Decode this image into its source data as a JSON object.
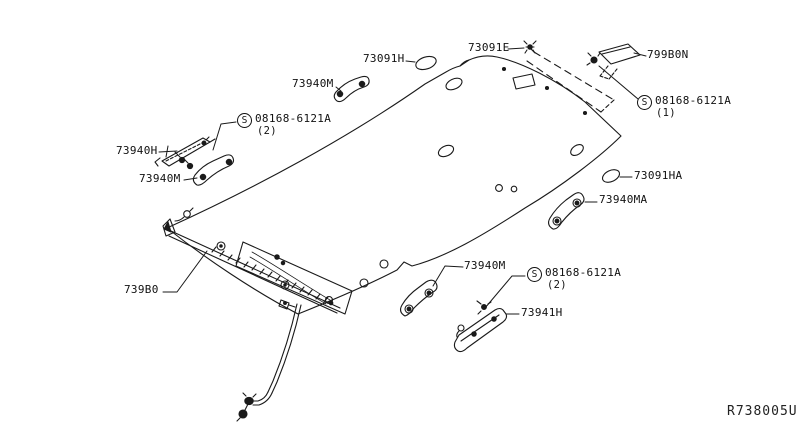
{
  "ref_code": "R738005U",
  "s_marker": "S",
  "callouts": {
    "p73091H": "73091H",
    "p73091E": "73091E",
    "p799B0N": "799B0N",
    "p73940M": "73940M",
    "p73940H": "73940H",
    "p73091HA": "73091HA",
    "p73940MA": "73940MA",
    "p739B0": "739B0",
    "p73941H": "73941H",
    "screw_top_right": {
      "code": "08168-6121A",
      "qty": "(1)"
    },
    "screw_top_left": {
      "code": "08168-6121A",
      "qty": "(2)"
    },
    "screw_bottom": {
      "code": "08168-6121A",
      "qty": "(2)"
    }
  },
  "colors": {
    "line": "#1a1a1a",
    "background": "#ffffff"
  }
}
